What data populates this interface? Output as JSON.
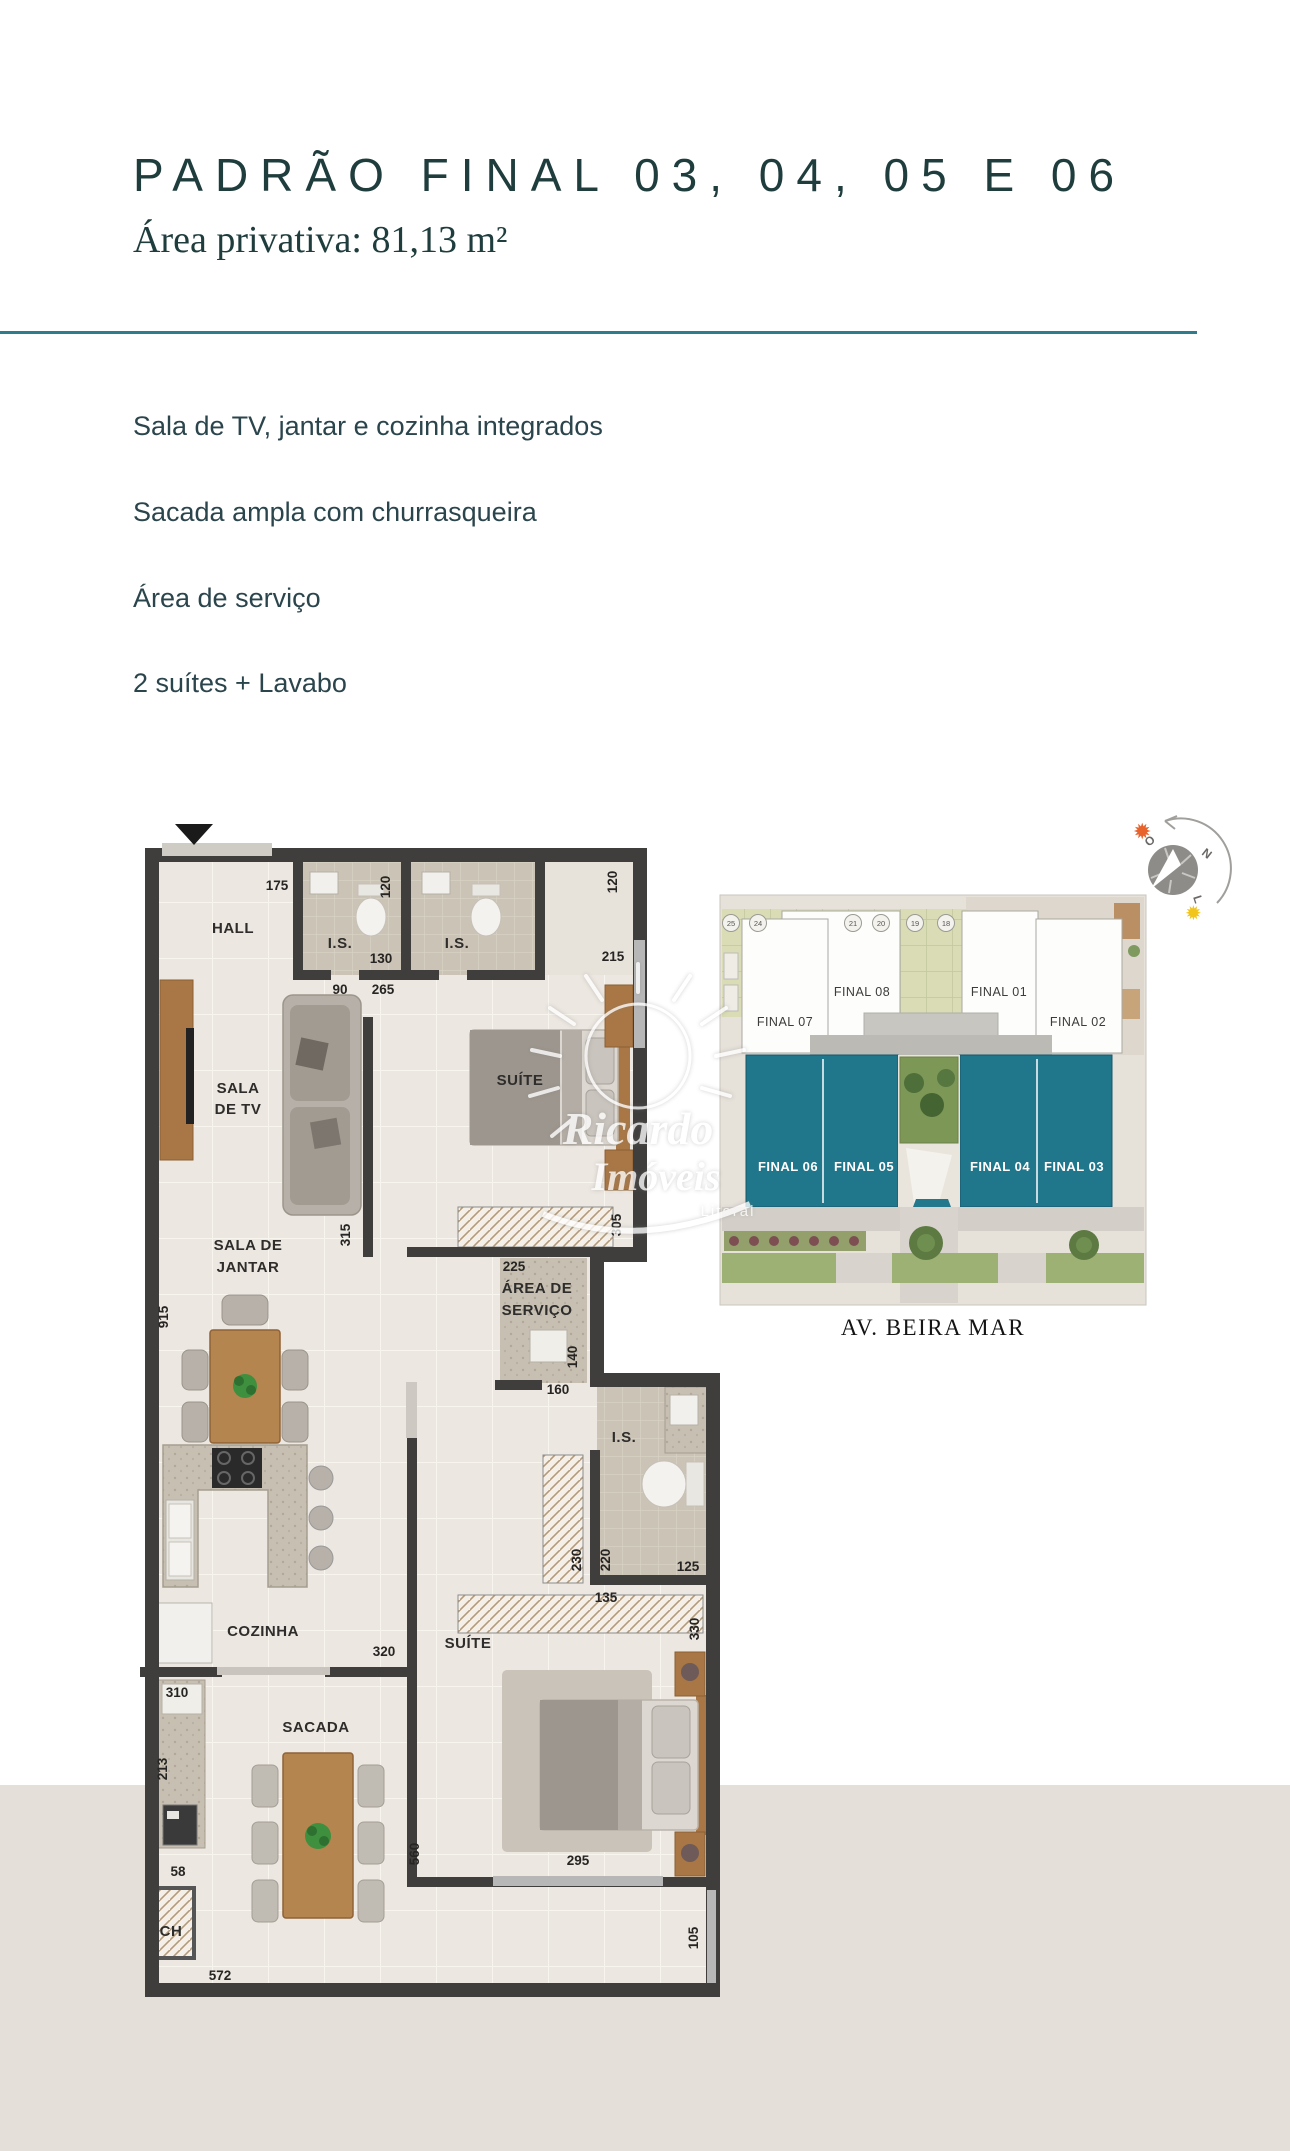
{
  "page": {
    "bg_top": "#ffffff",
    "bg_bottom": "#e4dfd8"
  },
  "header": {
    "title": "PADRÃO FINAL 03, 04, 05 E 06",
    "subtitle": "Área privativa: 81,13 m²",
    "title_color": "#1f3d3d",
    "divider_color": "#2f7d8c"
  },
  "features": {
    "f1": "Sala de TV, jantar e cozinha integrados",
    "f2": "Sacada ampla com churrasqueira",
    "f3": "Área de serviço",
    "f4": "2 suítes + Lavabo"
  },
  "floor_plan": {
    "rooms": {
      "hall": "HALL",
      "is1": "I.S.",
      "is2": "I.S.",
      "sala_tv_l1": "SALA",
      "sala_tv_l2": "DE TV",
      "suite1": "SUÍTE",
      "sala_jantar_l1": "SALA DE",
      "sala_jantar_l2": "JANTAR",
      "area_servico_l1": "ÁREA DE",
      "area_servico_l2": "SERVIÇO",
      "lavabo": "I.S.",
      "cozinha": "COZINHA",
      "suite2": "SUÍTE",
      "sacada": "SACADA",
      "ch": "CH"
    },
    "dims": {
      "d175": "175",
      "d120a": "120",
      "d120b": "120",
      "d130": "130",
      "d215": "215",
      "d90": "90",
      "d265": "265",
      "d305": "305",
      "d315": "315",
      "d915": "915",
      "d225": "225",
      "d140": "140",
      "d160": "160",
      "d230": "230",
      "d220": "220",
      "d125": "125",
      "d135": "135",
      "d320": "320",
      "d330": "330",
      "d310": "310",
      "d213": "213",
      "d560": "560",
      "d295": "295",
      "d58": "58",
      "d572": "572",
      "d105": "105"
    },
    "wall_color": "#3f3e3c"
  },
  "site_plan": {
    "units": {
      "f07": "FINAL 07",
      "f08": "FINAL 08",
      "f01": "FINAL 01",
      "f02": "FINAL 02",
      "f06": "FINAL 06",
      "f05": "FINAL 05",
      "f04": "FINAL 04",
      "f03": "FINAL 03"
    },
    "parking": {
      "p25": "25",
      "p24": "24",
      "p21": "21",
      "p20": "20",
      "p19": "19",
      "p18": "18"
    },
    "street": "AV. BEIRA MAR",
    "highlight_color": "#20768a"
  },
  "compass": {
    "west": "O",
    "north": "N",
    "east": "L"
  },
  "watermark": {
    "l1": "Ricardo",
    "l2": "Imóveis",
    "l3": "Litoral"
  }
}
